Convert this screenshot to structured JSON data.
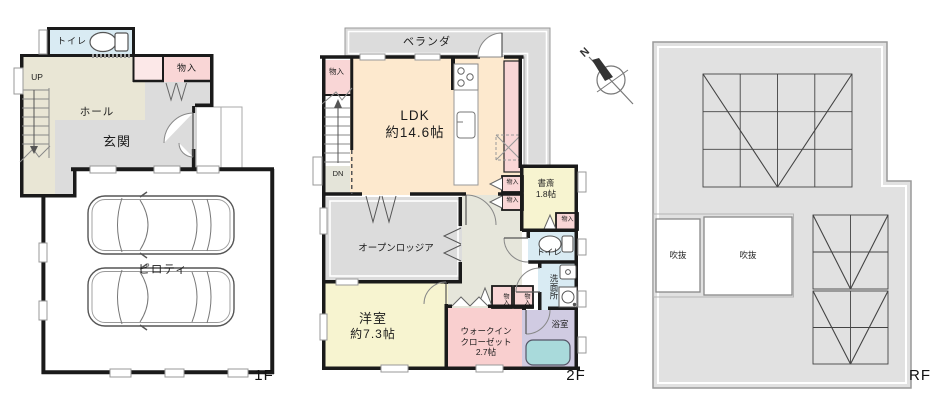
{
  "colors": {
    "wall": "#1a1a1a",
    "hall_beige": "#e9e6d5",
    "gray_room": "#dcdcdc",
    "pink_storage": "#f9d6d6",
    "pink_storage_light": "#fce8e8",
    "peach_ldk": "#fde9ce",
    "yellow_room": "#f7f4d0",
    "wic_pink": "#f9cfcf",
    "water_blue": "#d9ebf3",
    "bath_lavender": "#d0cbe2",
    "tub_teal": "#a9dadb",
    "rf_gray": "#e1e1e1"
  },
  "f1": {
    "floor_label": "1F",
    "toilet": "トイレ",
    "storage": "物入",
    "hall": "ホール",
    "entrance": "玄関",
    "stairs_up": "UP",
    "piloti": "ピロティ"
  },
  "f2": {
    "floor_label": "2F",
    "veranda": "ベランダ",
    "storage_top": "物入",
    "ldk_name": "LDK",
    "ldk_size": "約14.6帖",
    "stairs_down": "DN",
    "storage_a": "物入",
    "storage_b": "物入",
    "study_name": "書斎",
    "study_size": "1.8帖",
    "storage_study": "物入",
    "toilet": "トイレ",
    "washroom": "洗面所",
    "loggia": "オープンロッジア",
    "western_name": "洋室",
    "western_size": "約7.3帖",
    "wic_line1": "ウォークイン",
    "wic_line2": "クローゼット",
    "wic_size": "2.7帖",
    "closet_a": "物入",
    "closet_b": "物入",
    "bath": "浴室"
  },
  "rf": {
    "floor_label": "RF",
    "void_a": "吹抜",
    "void_b": "吹抜"
  },
  "compass": {
    "north": "N"
  }
}
